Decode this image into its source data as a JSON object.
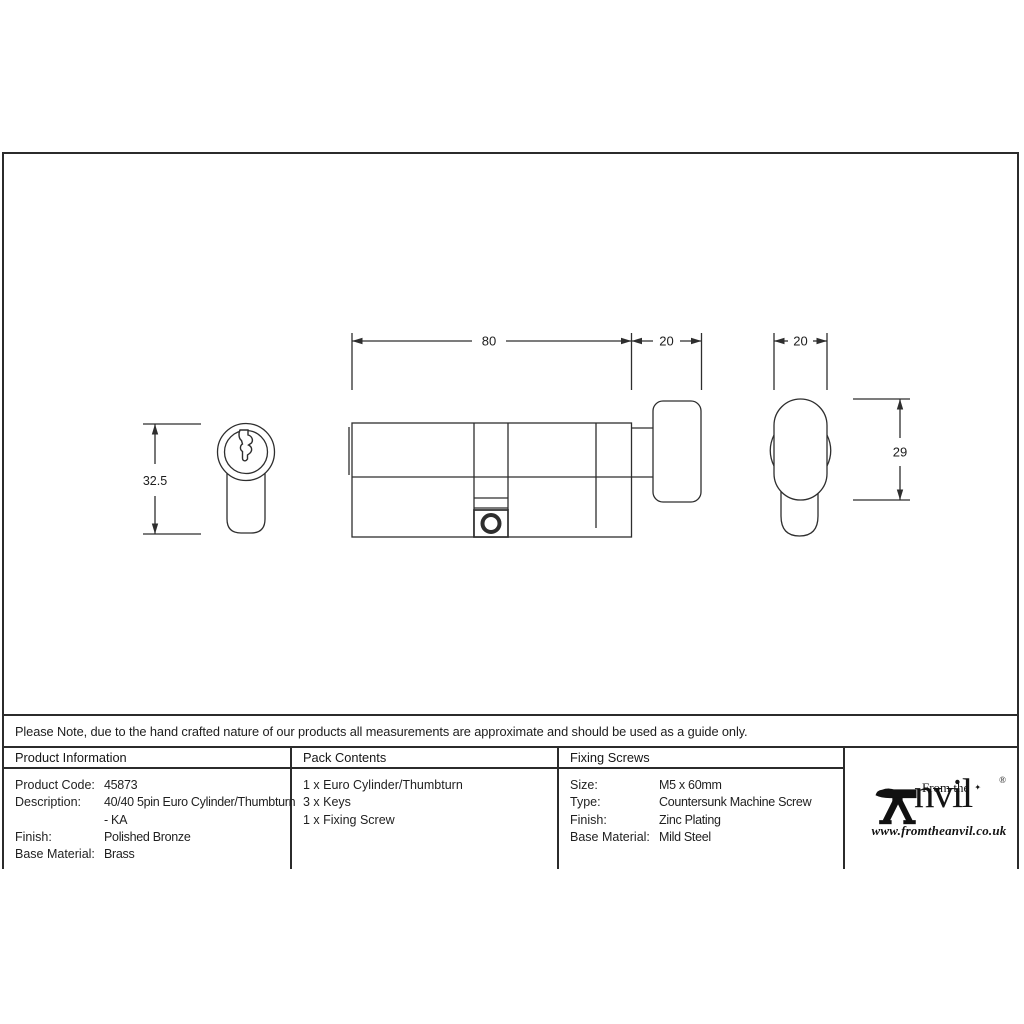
{
  "drawing": {
    "dim_body_length": "80",
    "dim_neck_length": "20",
    "dim_turn_width": "20",
    "dim_face_height": "32.5",
    "dim_turn_height": "29"
  },
  "note": {
    "text": "Please Note, due to the hand crafted nature of our products all measurements are approximate and should be used as a guide only."
  },
  "table": {
    "product_info": {
      "header": "Product Information",
      "rows": [
        {
          "label": "Product Code:",
          "value": "45873"
        },
        {
          "label": "Description:",
          "value": "40/40 5pin Euro Cylinder/Thumbturn"
        },
        {
          "label": "",
          "value": "- KA"
        },
        {
          "label": "Finish:",
          "value": "Polished Bronze"
        },
        {
          "label": "Base Material:",
          "value": "Brass"
        }
      ]
    },
    "pack_contents": {
      "header": "Pack Contents",
      "items": [
        "1 x Euro Cylinder/Thumbturn",
        "3 x Keys",
        "1 x Fixing Screw"
      ]
    },
    "fixing_screws": {
      "header": "Fixing Screws",
      "rows": [
        {
          "label": "Size:",
          "value": "M5 x 60mm"
        },
        {
          "label": "Type:",
          "value": "Countersunk Machine Screw"
        },
        {
          "label": "Finish:",
          "value": "Zinc Plating"
        },
        {
          "label": "Base Material:",
          "value": "Mild Steel"
        }
      ]
    }
  },
  "logo": {
    "tagline": "From the",
    "diamond": "✦",
    "name_rest": "nvil",
    "registered": "®",
    "url": "www.fromtheanvil.co.uk"
  }
}
